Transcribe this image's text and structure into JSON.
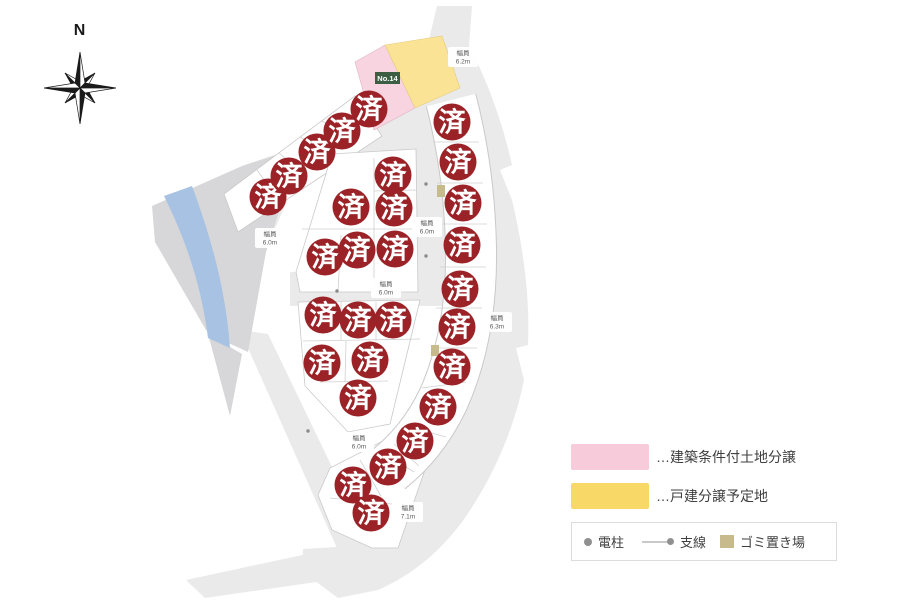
{
  "compass": {
    "label": "N"
  },
  "map": {
    "sold_label": "済",
    "marker_radius": 18.5,
    "lot_no_label": "No.14",
    "colors": {
      "sold_red": "#9b2328",
      "lot_pink": "#f8d3e0",
      "lot_yellow": "#fae395",
      "water_blue": "#a7c2e2",
      "road_gray": "#eaeaea",
      "left_area_gray": "#d7d7d9",
      "lot_no_green": "#3c5f43",
      "garbage_tan": "#c7ba8d"
    },
    "road_labels": [
      {
        "text": "幅員",
        "value": "6.2m",
        "x": 463,
        "y": 57
      },
      {
        "text": "幅員",
        "value": "6.0m",
        "x": 270,
        "y": 238
      },
      {
        "text": "幅員",
        "value": "6.0m",
        "x": 427,
        "y": 227
      },
      {
        "text": "幅員",
        "value": "6.0m",
        "x": 386,
        "y": 288
      },
      {
        "text": "幅員",
        "value": "6.3m",
        "x": 497,
        "y": 322
      },
      {
        "text": "幅員",
        "value": "6.0m",
        "x": 359,
        "y": 442
      },
      {
        "text": "幅員",
        "value": "7.1m",
        "x": 408,
        "y": 512
      }
    ],
    "sold_circles": [
      {
        "x": 268,
        "y": 197
      },
      {
        "x": 289,
        "y": 176
      },
      {
        "x": 317,
        "y": 152
      },
      {
        "x": 342,
        "y": 131
      },
      {
        "x": 369,
        "y": 109
      },
      {
        "x": 393,
        "y": 175
      },
      {
        "x": 351,
        "y": 207
      },
      {
        "x": 394,
        "y": 208
      },
      {
        "x": 357,
        "y": 250
      },
      {
        "x": 395,
        "y": 249
      },
      {
        "x": 325,
        "y": 257
      },
      {
        "x": 323,
        "y": 315
      },
      {
        "x": 358,
        "y": 320
      },
      {
        "x": 393,
        "y": 320
      },
      {
        "x": 322,
        "y": 363
      },
      {
        "x": 370,
        "y": 360
      },
      {
        "x": 358,
        "y": 398
      },
      {
        "x": 452,
        "y": 122
      },
      {
        "x": 458,
        "y": 162
      },
      {
        "x": 463,
        "y": 203
      },
      {
        "x": 462,
        "y": 245
      },
      {
        "x": 460,
        "y": 289
      },
      {
        "x": 457,
        "y": 327
      },
      {
        "x": 452,
        "y": 367
      },
      {
        "x": 438,
        "y": 407
      },
      {
        "x": 415,
        "y": 441
      },
      {
        "x": 388,
        "y": 467
      },
      {
        "x": 353,
        "y": 485
      },
      {
        "x": 371,
        "y": 513
      }
    ]
  },
  "legend": {
    "items": [
      {
        "color": "#f7cbd9",
        "label": "…建築条件付土地分譲"
      },
      {
        "color": "#f8d967",
        "label": "…戸建分譲予定地"
      }
    ],
    "symbols": {
      "pole": "電柱",
      "wire": "支線",
      "garbage": "ゴミ置き場"
    }
  }
}
